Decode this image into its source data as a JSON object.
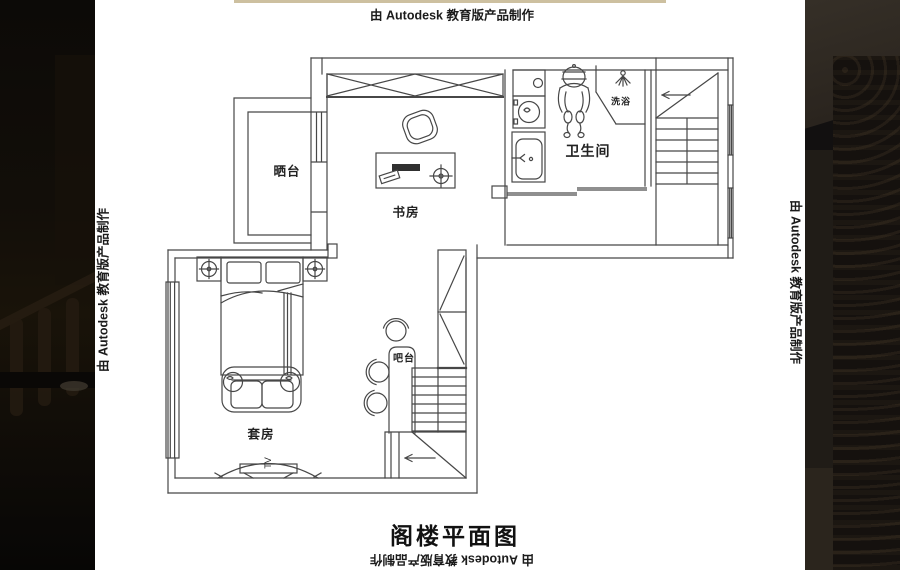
{
  "watermark": {
    "text": "由 Autodesk 教育版产品制作"
  },
  "title": {
    "text": "阁楼平面图"
  },
  "rooms": {
    "terrace": "晒台",
    "study": "书房",
    "bathroom": "卫生间",
    "suite": "套房",
    "bar": "吧台",
    "shower": "洗浴"
  },
  "labels": {
    "tv": "TV"
  },
  "colors": {
    "line": "#474747",
    "paper": "#ffffff",
    "watermark_text": "#1b1b1b",
    "top_strip": "#cdc0a0",
    "side_panel_dark": "#0e0b08"
  }
}
